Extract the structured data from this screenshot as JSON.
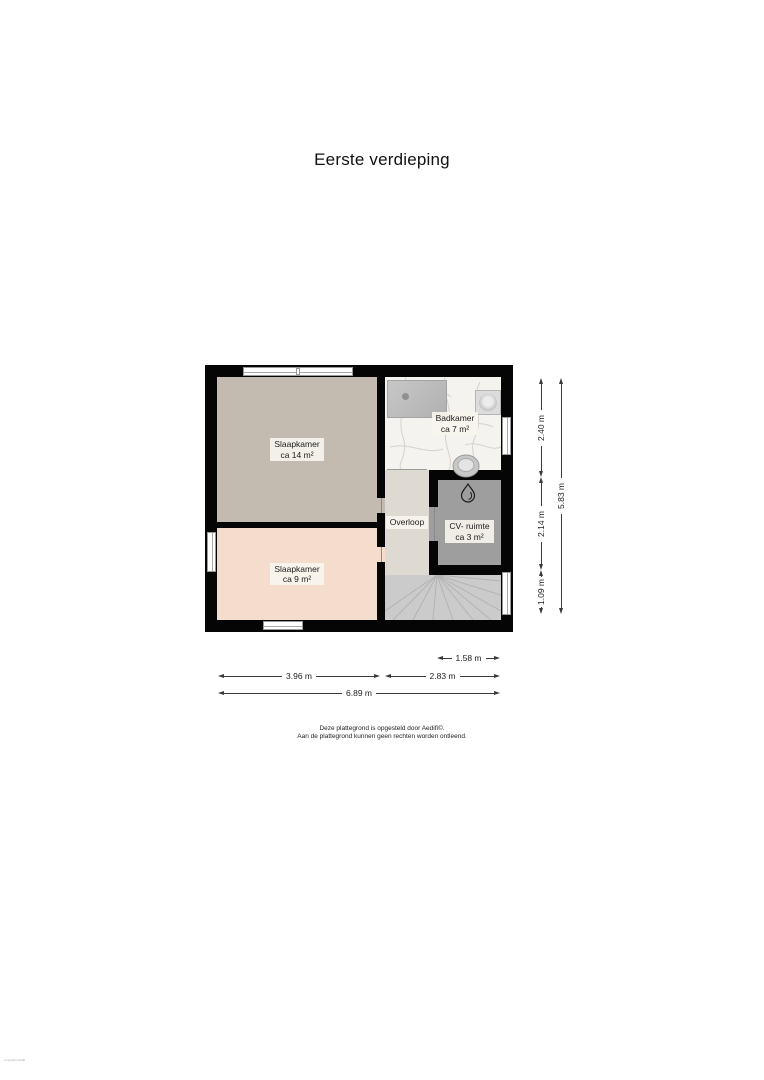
{
  "title": "Eerste verdieping",
  "plan": {
    "rooms": [
      {
        "id": "slaapkamer-14",
        "name": "Slaapkamer",
        "area": "ca 14 m²",
        "color": "#c3bab0"
      },
      {
        "id": "badkamer",
        "name": "Badkamer",
        "area": "ca 7 m²",
        "color": "#f4f3f0"
      },
      {
        "id": "slaapkamer-9",
        "name": "Slaapkamer",
        "area": "ca 9 m²",
        "color": "#f4ddcd"
      },
      {
        "id": "overloop",
        "name": "Overloop",
        "area": "",
        "color": "#dedad1"
      },
      {
        "id": "cv-ruimte",
        "name": "CV- ruimte",
        "area": "ca 3 m²",
        "color": "#9e9e9e"
      }
    ],
    "wall_color": "#050505",
    "stairs_color": "#cbcbcb"
  },
  "dimensions": {
    "right": [
      "2.40 m",
      "2.14 m",
      "1.09 m",
      "5.83 m"
    ],
    "bottom": [
      "1.58 m",
      "3.96 m",
      "2.83 m",
      "6.89 m"
    ]
  },
  "footer": {
    "line1": "Deze plattegrond is opgesteld door Aedifi©.",
    "line2": "Aan de plattegrond kunnen geen rechten worden ontleend."
  },
  "watermark": "Copyright Aedifi"
}
